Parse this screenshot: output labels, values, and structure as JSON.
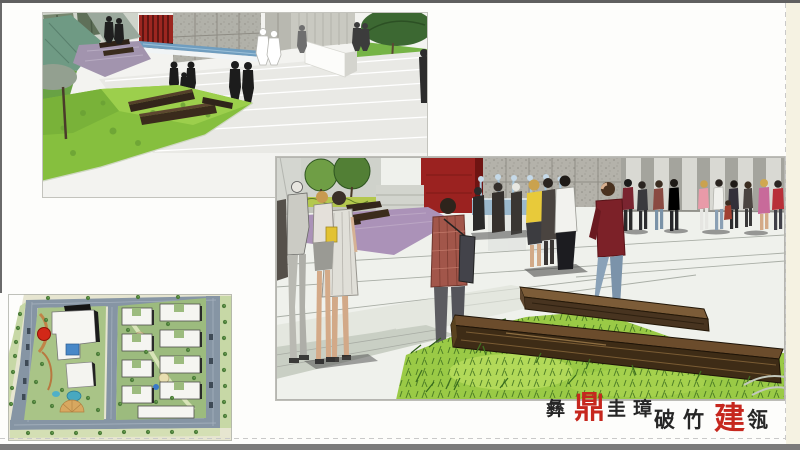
{
  "slide": {
    "background_color": "#fdfdfb",
    "margin_strip_color": "#f5f2e2",
    "chrome_bar_color": "#6a6a6a",
    "bottom_bar_color": "#7b7b7b",
    "dashed_guide_color": "#c9c9c9"
  },
  "figures": {
    "top_render_name": "plaza-stairs-perspective-render",
    "main_render_name": "plaza-sketch-perspective-render",
    "site_plan_name": "residential-masterplan-site-plan"
  },
  "logo": {
    "line1_pre": "彝",
    "line1_accent": "鼎",
    "line1_post": "圭璋",
    "line2_pre": "破竹",
    "line2_accent": "建",
    "line2_post": "瓴",
    "text_color": "#262626",
    "accent_color": "#c6271e"
  }
}
